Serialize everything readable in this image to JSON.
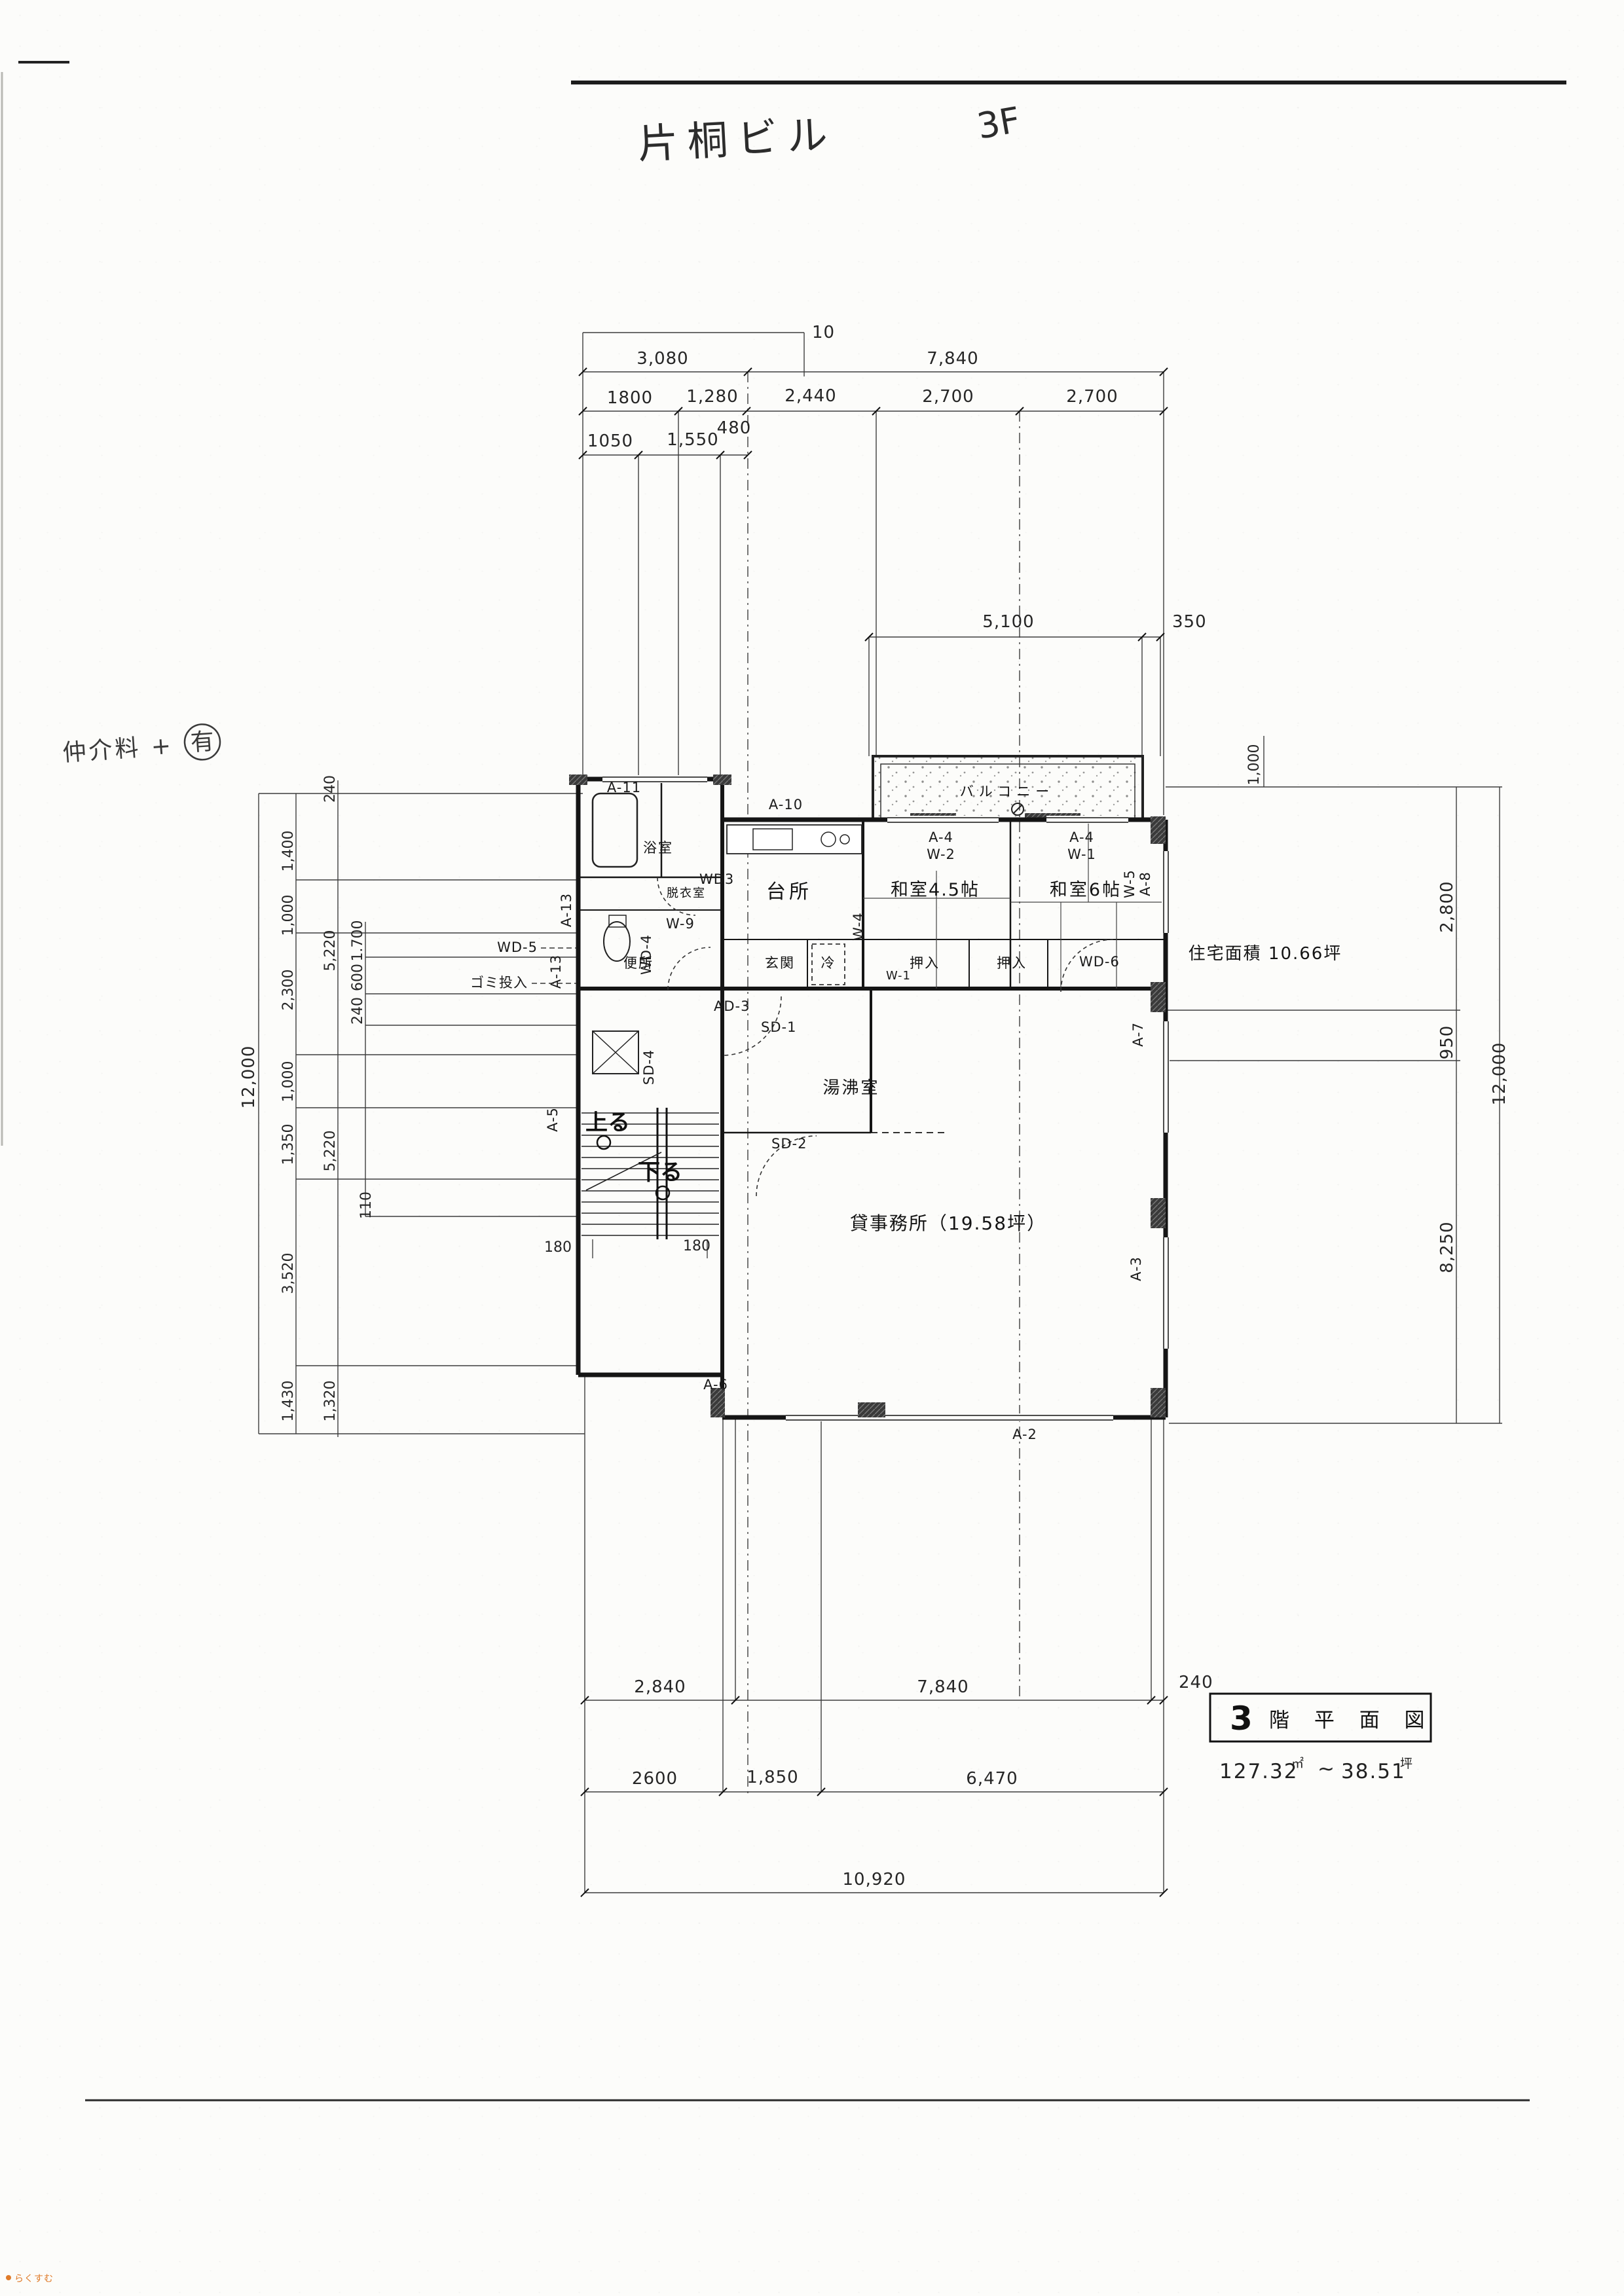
{
  "page": {
    "handwritten_title": "片桐ビル",
    "handwritten_floor": "3F",
    "handwritten_note": "仲介料 +",
    "note_circle": "有",
    "watermark": "らくすむ"
  },
  "title_block": {
    "floor": "3",
    "label": "階 平 面 図",
    "area_m2": "127.32",
    "area_m2_unit": "㎡",
    "tilde": "~",
    "area_tsubo": "38.51",
    "area_tsubo_unit": "坪"
  },
  "rooms": {
    "balcony": "バルコニー",
    "kitchen": "台所",
    "tatami45": "和室4.5帖",
    "tatami6": "和室6帖",
    "bath": "浴室",
    "dressing": "脱衣室",
    "toilet": "便所",
    "entrance": "玄関",
    "fridge": "冷",
    "closet1": "押入",
    "closet2": "押入",
    "hot_water": "湯沸室",
    "office": "貸事務所（19.58坪）",
    "residence_area": "住宅面積 10.66坪",
    "stairs_up": "上る",
    "stairs_down": "下る",
    "chute_note": "ゴミ投入"
  },
  "fixtures": {
    "a11": "A-11",
    "a10": "A-10",
    "a4_1": "A-4",
    "w2": "W-2",
    "a4_2": "A-4",
    "w1": "W-1",
    "w5": "W-5",
    "a8": "A-8",
    "a7": "A-7",
    "a3": "A-3",
    "a2": "A-2",
    "a6": "A-6",
    "a5": "A-5",
    "a13a": "A-13",
    "a13b": "A-13",
    "wd3": "WD3",
    "wd4": "WD-4",
    "wd5": "WD-5",
    "wd6": "WD-6",
    "ad3": "AD-3",
    "sd1": "SD-1",
    "sd2": "SD-2",
    "sd4": "SD-4",
    "w9": "W-9",
    "w4": "W-4",
    "w1b": "W-1"
  },
  "dims": {
    "top": {
      "grid": "10",
      "d3080": "3,080",
      "d7840": "7,840",
      "row2": [
        "1800",
        "1,280",
        "2,440",
        "2,700",
        "2,700"
      ],
      "row3": [
        "1050",
        "1,550",
        "480"
      ],
      "balcony": [
        "5,100",
        "350"
      ],
      "r1000": "1,000"
    },
    "left": {
      "outer": "12,000",
      "c1": [
        "1,400",
        "1,000",
        "2,300",
        "1,000",
        "1,350",
        "3,520",
        "1,430"
      ],
      "c2": [
        "240",
        "5,220",
        "5,220",
        "1,320"
      ],
      "c3": [
        "1.700",
        "600",
        "240",
        "110"
      ]
    },
    "right": {
      "c": [
        "2,800",
        "950",
        "8,250"
      ],
      "outer": "12,000"
    },
    "bottom": {
      "row1": [
        "2,840",
        "7,840",
        "240"
      ],
      "row2": [
        "2600",
        "1,850",
        "6,470"
      ],
      "total": "10,920"
    },
    "stairs": [
      "180",
      "180"
    ]
  }
}
